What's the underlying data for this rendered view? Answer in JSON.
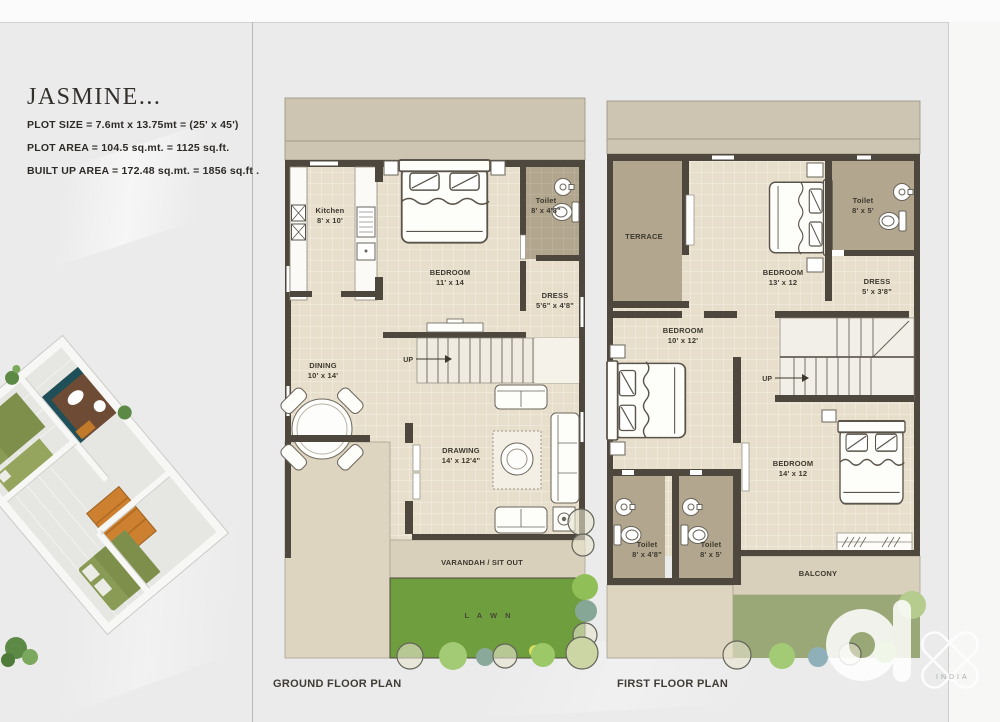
{
  "project": {
    "title": "JASMINE...",
    "specs": [
      "PLOT SIZE  = 7.6mt x 13.75mt = (25' x 45')",
      "PLOT AREA = 104.5 sq.mt.  = 1125 sq.ft.",
      "BUILT UP AREA = 172.48 sq.mt. = 1856 sq.ft ."
    ]
  },
  "ground_floor": {
    "title": "GROUND FLOOR PLAN",
    "up_label": "UP",
    "kitchen": {
      "name": "Kitchen",
      "dims": "8' x 10'"
    },
    "bedroom": {
      "name": "BEDROOM",
      "dims": "11' x 14"
    },
    "toilet": {
      "name": "Toilet",
      "dims": "8' x 4'8\""
    },
    "dress": {
      "name": "DRESS",
      "dims": "5'6\" x 4'8\""
    },
    "dining": {
      "name": "DINING",
      "dims": "10' x 14'"
    },
    "drawing": {
      "name": "DRAWING",
      "dims": "14' x 12'4\""
    },
    "varandah": {
      "name": "VARANDAH / SIT OUT"
    },
    "lawn": {
      "name": "L A W N"
    }
  },
  "first_floor": {
    "title": "FIRST FLOOR PLAN",
    "up_label": "UP",
    "terrace": {
      "name": "TERRACE"
    },
    "bedroom1": {
      "name": "BEDROOM",
      "dims": "13' x 12"
    },
    "toilet1": {
      "name": "Toilet",
      "dims": "8' x 5'"
    },
    "dress": {
      "name": "DRESS",
      "dims": "5' x 3'8\""
    },
    "bedroom2": {
      "name": "BEDROOM",
      "dims": "10' x 12'"
    },
    "bedroom3": {
      "name": "BEDROOM",
      "dims": "14' x 12"
    },
    "toilet2": {
      "name": "Toilet",
      "dims": "8' x 4'8\""
    },
    "toilet3": {
      "name": "Toilet",
      "dims": "8' x 5'"
    },
    "balcony": {
      "name": "BALCONY"
    }
  },
  "watermark": {
    "brand": "olx",
    "region": "INDIA"
  },
  "colors": {
    "wall": "#4e473d",
    "tile": "#e7dfcc",
    "khaki": "#b2a78e",
    "band": "#cdc4b1",
    "varandah": "#d9d0bb",
    "lawn": "#6f9e3e",
    "upper_green": "#9aa878",
    "text": "#3d382f"
  }
}
